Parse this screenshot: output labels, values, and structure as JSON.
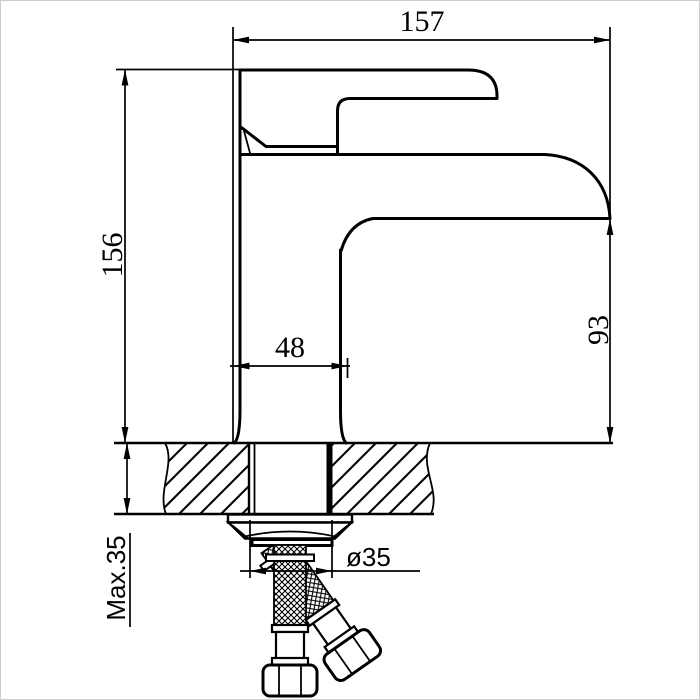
{
  "dims": {
    "overall_width": "157",
    "overall_height": "156",
    "base_width": "48",
    "spout_to_deck": "93",
    "hole_diameter": "ø35",
    "max_deck_thickness": "Max.35"
  },
  "colors": {
    "line": "#000000",
    "background": "#ffffff",
    "frame": "#cccccc"
  }
}
